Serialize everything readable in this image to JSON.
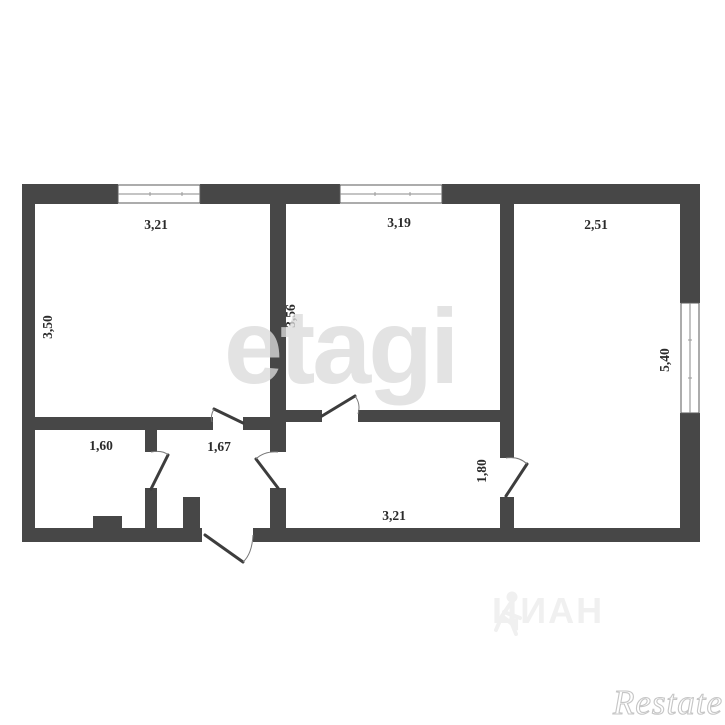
{
  "plan": {
    "rooms": [
      {
        "id": "room-top-left",
        "width_label": "3,21",
        "height_label": "3,50"
      },
      {
        "id": "room-middle",
        "width_label": "3,19",
        "height_label": "3,56"
      },
      {
        "id": "room-right",
        "width_label": "2,51",
        "height_label": "5,40"
      },
      {
        "id": "room-bottom-left",
        "width_label": "1,60"
      },
      {
        "id": "hallway",
        "width_label": "1,67"
      },
      {
        "id": "corridor",
        "width_label": "3,21",
        "doorway_label": "1,80"
      }
    ]
  },
  "watermarks": {
    "center_logo": "etagi",
    "portal_logo": "ЦИАН",
    "corner_logo": "Restate"
  },
  "colors": {
    "wall": "#474747",
    "background": "#ffffff",
    "label": "#2b2b2b",
    "watermark": "#dbdbdb"
  }
}
